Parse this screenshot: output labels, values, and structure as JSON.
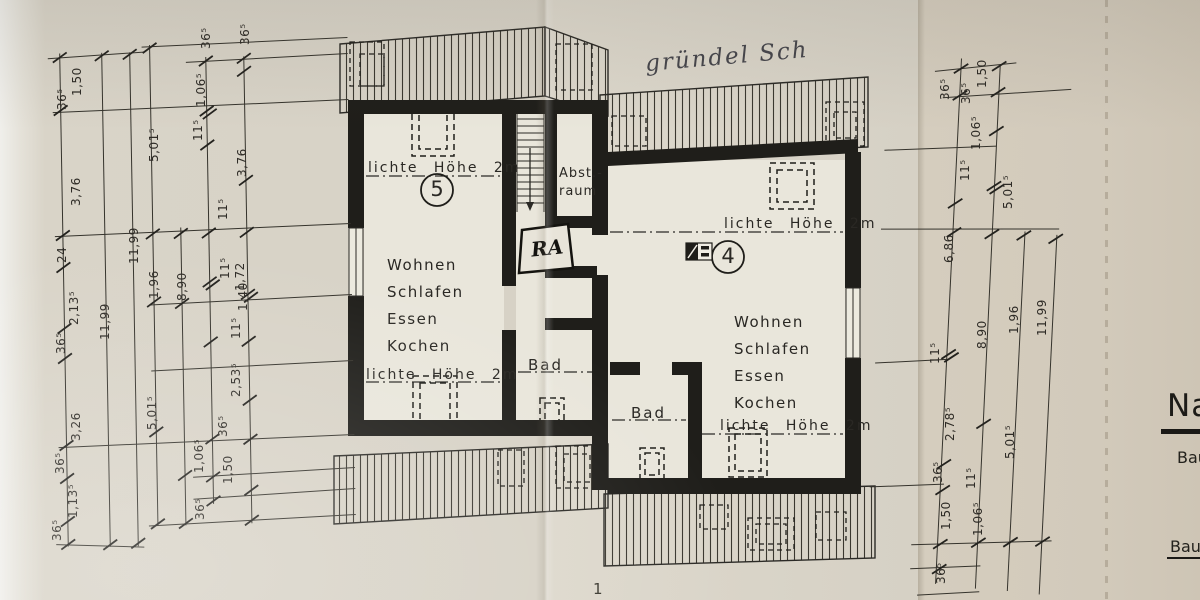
{
  "photo": {
    "handwritten_note": "gründel Sch",
    "page_number": "1"
  },
  "units": [
    {
      "number": "5",
      "clear_height_top": "lichte Höhe 2m",
      "clear_height_bottom": "lichte Höhe 2m",
      "rooms": [
        "Wohnen",
        "Schlafen",
        "Essen",
        "Kochen"
      ],
      "bath": "Bad"
    },
    {
      "number": "4",
      "clear_height_top": "lichte Höhe 2m",
      "clear_height_bottom": "lichte Höhe 2m",
      "rooms": [
        "Wohnen",
        "Schlafen",
        "Essen",
        "Kochen"
      ],
      "bath": "Bad"
    }
  ],
  "center": {
    "storage_line1": "Abst.-",
    "storage_line2": "raum",
    "tag": "RA"
  },
  "title_block": {
    "heading": "Na",
    "line1": "Bau",
    "line2": "Bau"
  },
  "dimensions": {
    "left": [
      {
        "t": "1,50",
        "x": 70,
        "y": 96
      },
      {
        "t": "36⁵",
        "x": 55,
        "y": 110
      },
      {
        "t": "3,76",
        "x": 69,
        "y": 206
      },
      {
        "t": "24",
        "x": 55,
        "y": 263
      },
      {
        "t": "2,13⁵",
        "x": 67,
        "y": 325
      },
      {
        "t": "36⁵",
        "x": 54,
        "y": 354
      },
      {
        "t": "3,26",
        "x": 69,
        "y": 441
      },
      {
        "t": "36⁵",
        "x": 53,
        "y": 474
      },
      {
        "t": "1,13⁵",
        "x": 66,
        "y": 518
      },
      {
        "t": "36⁵",
        "x": 50,
        "y": 541
      },
      {
        "t": "11,99",
        "x": 98,
        "y": 340
      },
      {
        "t": "11,99",
        "x": 127,
        "y": 264
      },
      {
        "t": "5,01⁵",
        "x": 147,
        "y": 162
      },
      {
        "t": "1,96",
        "x": 147,
        "y": 299
      },
      {
        "t": "5,01⁵",
        "x": 145,
        "y": 430
      },
      {
        "t": "8,90",
        "x": 175,
        "y": 301
      },
      {
        "t": "1,06⁵",
        "x": 194,
        "y": 107
      },
      {
        "t": "11⁵",
        "x": 191,
        "y": 141
      },
      {
        "t": "36⁵",
        "x": 199,
        "y": 49
      },
      {
        "t": "36⁵",
        "x": 238,
        "y": 45
      },
      {
        "t": "3,76",
        "x": 235,
        "y": 177
      },
      {
        "t": "11⁵",
        "x": 216,
        "y": 220
      },
      {
        "t": "1,72",
        "x": 233,
        "y": 291
      },
      {
        "t": "11⁵",
        "x": 218,
        "y": 279
      },
      {
        "t": "1,40",
        "x": 236,
        "y": 311
      },
      {
        "t": "11⁵",
        "x": 229,
        "y": 339
      },
      {
        "t": "2,53⁵",
        "x": 229,
        "y": 397
      },
      {
        "t": "36⁵",
        "x": 216,
        "y": 437
      },
      {
        "t": "1,06⁵",
        "x": 192,
        "y": 473
      },
      {
        "t": "1,50",
        "x": 221,
        "y": 484
      },
      {
        "t": "36⁵",
        "x": 193,
        "y": 520
      }
    ],
    "right": [
      {
        "t": "1,50",
        "x": 975,
        "y": 88
      },
      {
        "t": "36⁵",
        "x": 938,
        "y": 100
      },
      {
        "t": "36⁵",
        "x": 959,
        "y": 104
      },
      {
        "t": "1,06⁵",
        "x": 969,
        "y": 150
      },
      {
        "t": "11⁵",
        "x": 958,
        "y": 181
      },
      {
        "t": "5,01⁵",
        "x": 1001,
        "y": 209
      },
      {
        "t": "6,86",
        "x": 942,
        "y": 263
      },
      {
        "t": "8,90",
        "x": 975,
        "y": 349
      },
      {
        "t": "1,96",
        "x": 1007,
        "y": 334
      },
      {
        "t": "11,99",
        "x": 1035,
        "y": 336
      },
      {
        "t": "11⁵",
        "x": 928,
        "y": 364
      },
      {
        "t": "2,78⁵",
        "x": 943,
        "y": 441
      },
      {
        "t": "5,01⁵",
        "x": 1003,
        "y": 459
      },
      {
        "t": "36⁵",
        "x": 931,
        "y": 483
      },
      {
        "t": "11⁵",
        "x": 964,
        "y": 489
      },
      {
        "t": "1,50",
        "x": 939,
        "y": 530
      },
      {
        "t": "1,06⁵",
        "x": 971,
        "y": 536
      },
      {
        "t": "36⁵",
        "x": 934,
        "y": 584
      }
    ]
  },
  "colors": {
    "paper": "#d8d3c7",
    "paper_right": "#d2cabb",
    "ink": "#2b2a26",
    "wall": "#1f1e1a",
    "room": "#e9e6db"
  }
}
